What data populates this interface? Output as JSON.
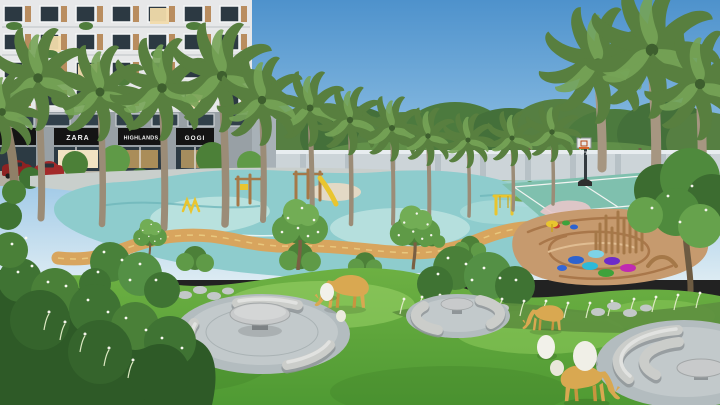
{
  "scene": {
    "title": "Residential complex landscape garden — 3D architectural rendering",
    "setting": "daytime, clear blue sky",
    "description": "Aerial view of an apartment tower amenity garden with a children's playground on aqua safety surfacing, palm trees, jogging path, basketball court, sand play area, stone seating circles, deer sculptures and egg-shaped stones"
  },
  "building": {
    "storefront_signs": [
      {
        "label": "ZARA"
      },
      {
        "label": "HIGHLANDS"
      },
      {
        "label": "GOGI"
      }
    ]
  },
  "palette": {
    "sky_top": "#4e92cc",
    "sky_horizon": "#dcebf3",
    "facade": "#e7e8e9",
    "play_surface": "#8ecccd",
    "play_surface_light": "#bfe4e1",
    "path_tan": "#d8a55e",
    "grass": "#5ba338",
    "grass_light": "#86c957",
    "foliage": "#4c8038",
    "palm_frond": "#587f3f",
    "stone_plaza": "#b3bcbf",
    "granite_bench": "#cbcdca",
    "sand": "#c69a6e",
    "sand_swirl": "#a9774a",
    "deer": "#d9a851",
    "egg": "#f2f1ea",
    "court": "#7fc0ae",
    "court_key": "#e8c7ca",
    "wall": "#ccd4d8",
    "wood": "#a57848",
    "accent_yellow": "#e9c52f",
    "car_red": "#8e2222",
    "sign_bg": "#141414",
    "sign_text": "#f5f5f5"
  },
  "objects": [
    "residential-tower",
    "retail-storefronts",
    "palm-trees",
    "children-playground-surface",
    "wooden-play-structures",
    "yellow-play-equipment",
    "basketball-court",
    "basketball-hoop",
    "sand-play-area",
    "colored-stepping-pads",
    "climbing-pole-cluster",
    "jogging-path",
    "boundary-wall",
    "park-trees",
    "lawn-mounds",
    "stone-seating-circles",
    "stone-tables",
    "curved-granite-benches",
    "deer-sculptures",
    "egg-shaped-stones",
    "stepping-stones",
    "flowering-shrubs",
    "ornamental-grasses",
    "parked-cars"
  ]
}
